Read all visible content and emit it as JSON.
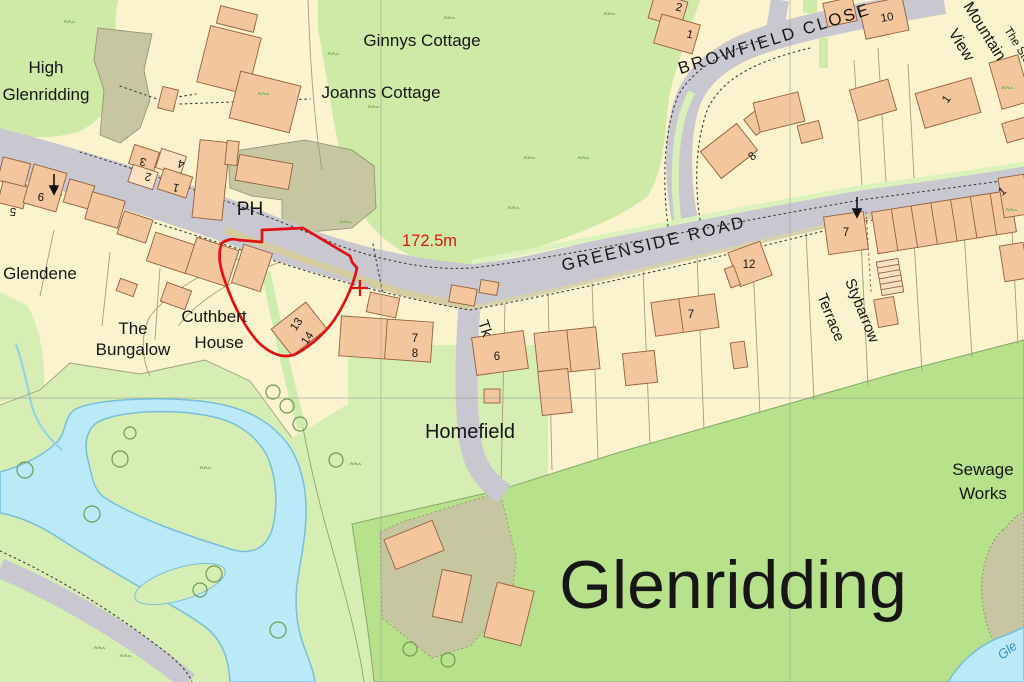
{
  "labels": {
    "high1": "High",
    "high2": "Glenridding",
    "ginnys": "Ginnys Cottage",
    "joanns": "Joanns Cottage",
    "ph": "PH",
    "spot_height": "172.5m",
    "greenside_road": "GREENSIDE ROAD",
    "browfield_close": "BROWFIELD CLOSE",
    "mountain1": "Mountain",
    "mountain2": "View",
    "the_stores": "The Stores",
    "glendene": "Glendene",
    "bungalow1": "The",
    "bungalow2": "Bungalow",
    "cuthbert1": "Cuthbert",
    "cuthbert2": "House",
    "homefield": "Homefield",
    "stybarrow1": "Stybarrow",
    "stybarrow2": "Terrace",
    "sewage1": "Sewage",
    "sewage2": "Works",
    "glenridding_big": "Glenridding",
    "tank": "Tk",
    "river": "Gle"
  },
  "numbers": {
    "n3": "3",
    "n2a": "2",
    "n4": "4",
    "n1a": "1",
    "n9": "9",
    "n5": "5",
    "n13": "13",
    "n14": "14",
    "n7a": "7",
    "n8a": "8",
    "n6": "6",
    "n12": "12",
    "n7b": "7",
    "n7c": "7",
    "n8b": "8",
    "n10": "10",
    "n2b": "2",
    "n1b": "1",
    "n1c": "1",
    "n1d": "1"
  },
  "colors": {
    "parcel_cream": "#faf3cd",
    "field_green": "#cfe9a6",
    "meadow_green": "#d6eeb4",
    "big_field_green": "#b8e18c",
    "khaki": "#c6c6a0",
    "road_gray": "#c9c7d0",
    "building_orange": "#f4c69d",
    "building_outline": "#93603c",
    "water_blue": "#bce9f8",
    "water_edge": "#76bedc",
    "boundary_red": "#e20f12",
    "spot_height_red": "#dd1612"
  }
}
